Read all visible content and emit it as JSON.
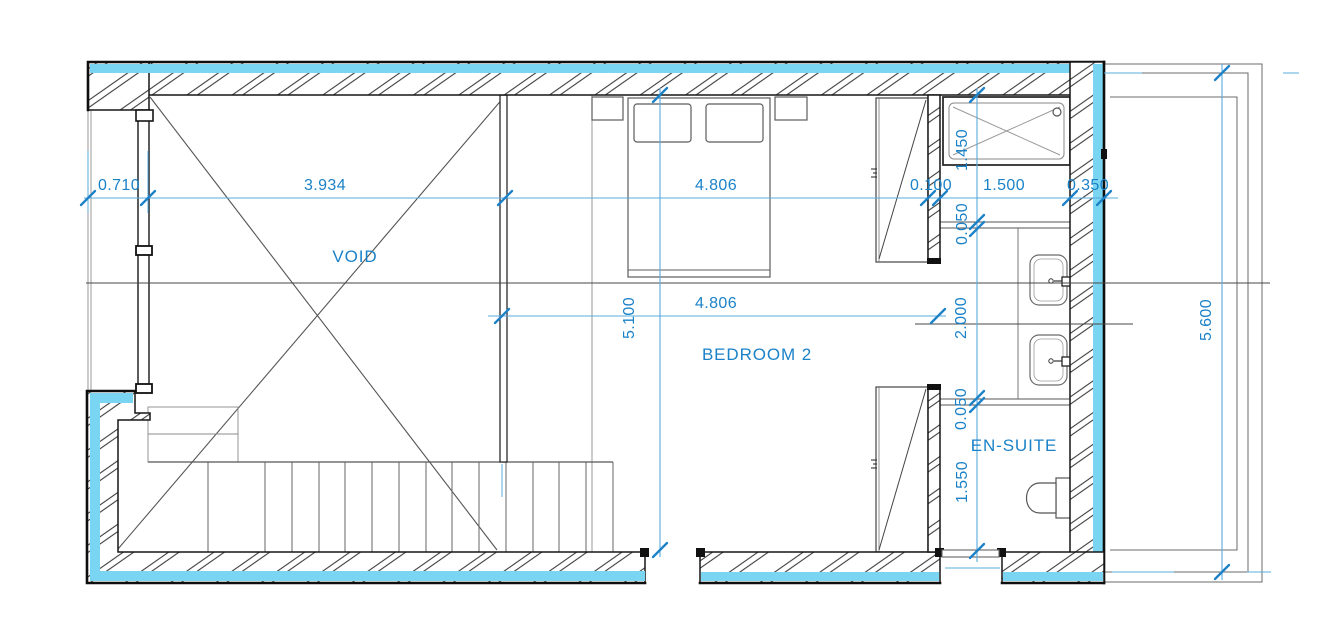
{
  "drawing": {
    "rooms": [
      {
        "label": "VOID"
      },
      {
        "label": "BEDROOM 2"
      },
      {
        "label": "EN-SUITE"
      }
    ],
    "dimensions": {
      "top_chain": [
        "0.710",
        "3.934",
        "4.806",
        "0.100",
        "1.500",
        "0.350"
      ],
      "bedroom_width": "4.806",
      "bedroom_depth": "5.100",
      "ensuite_chain": [
        "1.450",
        "0.050",
        "2.000",
        "0.050",
        "1.550"
      ],
      "terrace_depth": "5.600"
    },
    "colors": {
      "wall_highlight": "#79D5F1",
      "dimension": "#1B82C8"
    }
  }
}
